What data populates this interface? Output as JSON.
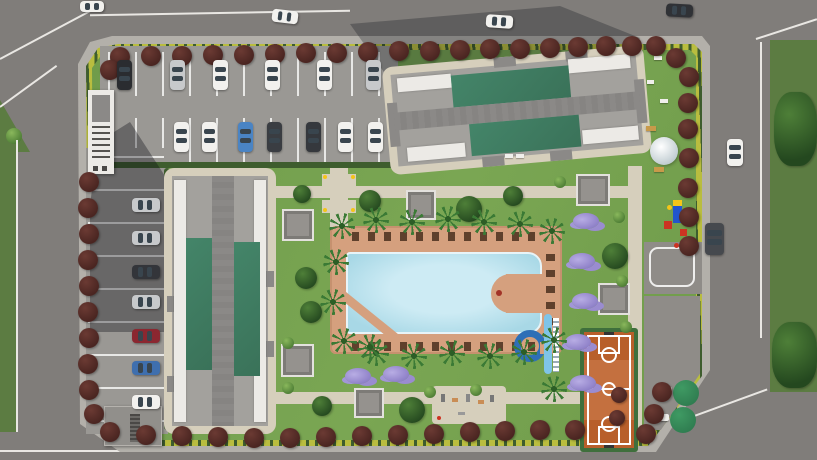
{
  "meta": {
    "title": "Aerial 3D render of a gated residential complex site plan",
    "view": "top-down bird's-eye",
    "render_type": "architectural visualization, no visible text"
  },
  "palette": {
    "road": "#807d7a",
    "roadLine": "#e9e7e3",
    "sidewalk": "#b3b0aa",
    "grassOuter": "#5c7c42",
    "lawn": "#6f9b4a",
    "hedgeYellow": "#b9bd3f",
    "hedgeDark": "#3e5d2e",
    "parking": "#9a9894",
    "stallLine": "#e8e8e6",
    "buildingGray": "#a3a19d",
    "buildingDark": "#8b8987",
    "buildingWhite": "#eceae6",
    "roofGreen": "#448569",
    "pathTan": "#d6cfbc",
    "pavement": "#8f8c88",
    "deckTan": "#d5a07e",
    "poolWater": "#a8d8e6",
    "poolWaterLight": "#cdebf4",
    "treeMaroon": "#4a2521",
    "treeMaroonHi": "#6b3a33",
    "treeGreen": "#24481f",
    "bushLight": "#4a7a33",
    "palmGreen": "#3b7a35",
    "purpleShrub": "#8d7fc7",
    "pergolaGray": "#95928e",
    "courtOrange": "#c4703f",
    "courtLine": "#ffffff",
    "courtBorder": "#3f6f3c",
    "gazeboGreen": "#2f7c50",
    "slideBlue": "#2e6fb7",
    "slideLight": "#7fc4e8",
    "domeWhite": "#e9eef0",
    "lounger": "#5f402c",
    "benchTan": "#c89a4a",
    "carWhite": "#f2f1ee",
    "carSilver": "#c7c9cb",
    "carDark": "#3a3d42",
    "carBlue": "#4a84c4",
    "carRed": "#8b2730",
    "playRed": "#cc3322",
    "playBlue": "#2255cc",
    "playYellow": "#f5c518"
  },
  "scene": {
    "site": {
      "label": "residential complex parcel",
      "boundary": "yellow-green hedge with maroon ornamental trees"
    },
    "roads": {
      "label": "perimeter public roads",
      "vehicles_moving": 6
    },
    "parking": {
      "label": "L-shaped surface parking",
      "cars_parked": 20,
      "structures": [
        "covered entrance walkway",
        "utility building"
      ]
    },
    "buildings": [
      {
        "name": "block-a",
        "position": "north",
        "roof": "gray core with two green roof wings and white end strips"
      },
      {
        "name": "block-b",
        "position": "west",
        "roof": "gray core with two green roof wings and white edge strips"
      }
    ],
    "amenities": [
      "swimming-pool",
      "kids-pool-triangle",
      "water-slide",
      "pool-deck-with-loungers",
      "basketball-court",
      "playground",
      "play-dome",
      "gazebos",
      "pergolas",
      "outdoor-fitness-area",
      "walking-paths",
      "east-driveway-court"
    ],
    "vegetation": [
      "maroon-ornamental-trees",
      "palm-trees",
      "green-trees",
      "purple-flowering-shrubs",
      "light-bushes",
      "lawns",
      "boundary-hedge"
    ]
  }
}
